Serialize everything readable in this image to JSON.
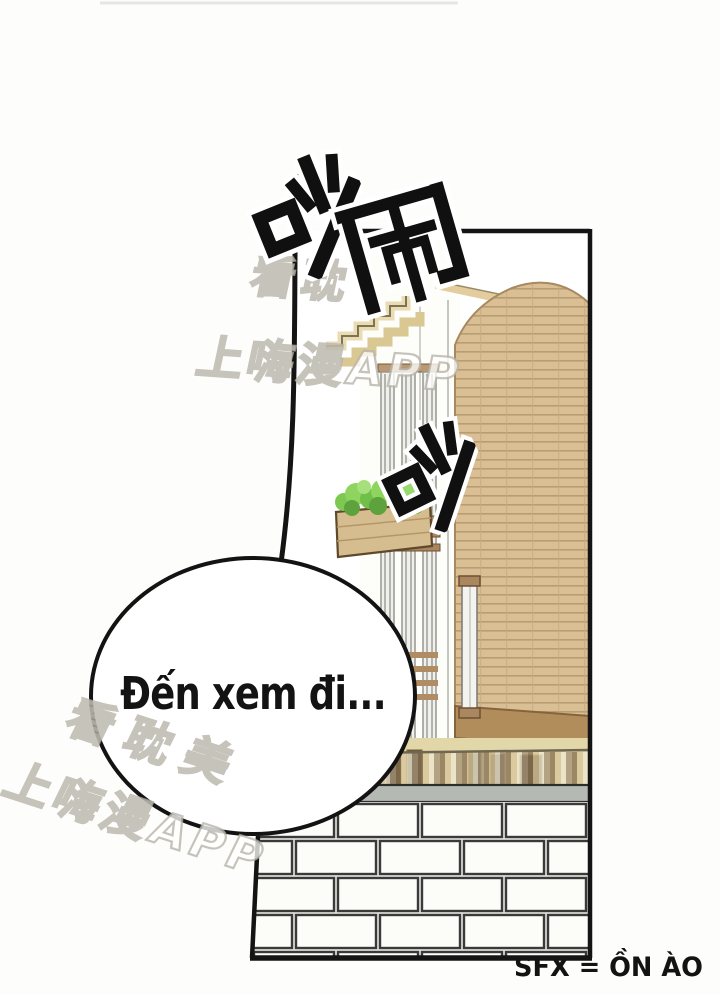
{
  "comic": {
    "speech_bubble": {
      "text": "Đến xem đi..."
    },
    "sfx_caption": {
      "text": "SFX = ỒN ÀO"
    },
    "sound_effects": [
      {
        "id": "chao-top",
        "text": "吵"
      },
      {
        "id": "nao-top",
        "text": "闹"
      },
      {
        "id": "chao-mid",
        "text": "吵"
      }
    ],
    "watermarks": {
      "top": {
        "line1": "看耽",
        "line2": "上嗨漫APP"
      },
      "bottom": {
        "line1": "看耽美",
        "line2": "上嗨漫APP"
      }
    },
    "colors": {
      "page_bg": "#fdfdfc",
      "ink": "#131313",
      "wood_facade": "#d9bf93",
      "wood_line": "#b99d72",
      "wood_dark_band": "#b28d5c",
      "cream_steps": "#e9dcb2",
      "khaki_ground": "#e2d7a9",
      "brick_fill": "#fcfcf9",
      "brick_line": "#3a3a3a",
      "wall_cap_gray": "#b4b9b3",
      "plant_green": "#7cc851",
      "planter_wood": "#d6bd8f",
      "watermark_outline": "#b5b1a6"
    }
  }
}
